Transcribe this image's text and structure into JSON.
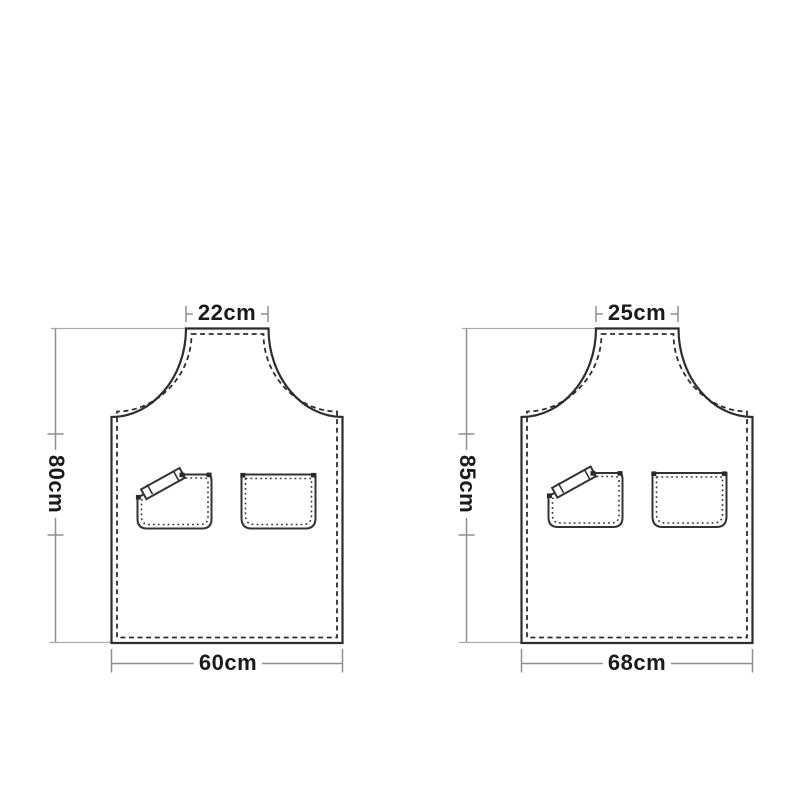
{
  "page": {
    "background_color": "#ffffff",
    "description": "Apron size specification diagram with two apron outlines, stitched seams, chest pockets and dimension callouts"
  },
  "diagram": {
    "unit": "cm",
    "aprons": [
      {
        "id": "small-apron",
        "neck_width": "22cm",
        "height": "80cm",
        "bottom_width": "60cm"
      },
      {
        "id": "large-apron",
        "neck_width": "25cm",
        "height": "85cm",
        "bottom_width": "68cm"
      }
    ],
    "features": {
      "pocket_left": "pen-pocket-with-diagonal-flap-and-strap",
      "pocket_right": "plain-patch-pocket",
      "seam_style": "dashed-topstitch"
    },
    "colors": {
      "outline": "#2d2d2d",
      "stitch": "#2e2e2e",
      "dimension_line": "#8f8f8f",
      "extension_line": "#ababab",
      "label_text": "#1a1a1a",
      "background": "#ffffff"
    }
  }
}
